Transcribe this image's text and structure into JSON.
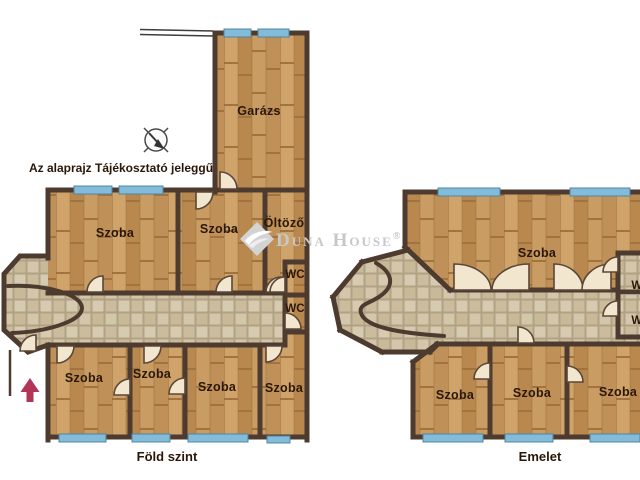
{
  "disclaimer": "Az alaprajz Tájékosztató jeleggű",
  "watermark": {
    "brand": "Duna House",
    "registered": "®"
  },
  "ground_floor": {
    "title": "Föld szint",
    "garage": "Garázs",
    "room_top_1": "Szoba",
    "room_top_2": "Szoba",
    "dressing": "Öltöző",
    "wc_1": "WC",
    "wc_2": "WC",
    "room_bottom_1": "Szoba",
    "room_bottom_2": "Szoba",
    "room_bottom_3": "Szoba",
    "room_bottom_4": "Szoba"
  },
  "upper_floor": {
    "title": "Emelet",
    "room_main": "Szoba",
    "wc_1": "WC",
    "wc_2": "WC",
    "room_bottom_1": "Szoba",
    "room_bottom_2": "Szoba",
    "room_bottom_3": "Szoba"
  },
  "icons": {
    "compass": "compass-icon",
    "entrance_arrow": "entrance-arrow-icon",
    "watermark_logo": "watermark-logo-icon"
  },
  "colors": {
    "wall": "#4e3b2f",
    "wood_floor": "#c6985f",
    "tile_floor": "#cdbfa3",
    "window": "#82bcd9",
    "door_leaf": "#f2e6cf",
    "label_text": "#2a1708",
    "entrance_arrow": "#b23457",
    "watermark": "#c7c7c7"
  }
}
